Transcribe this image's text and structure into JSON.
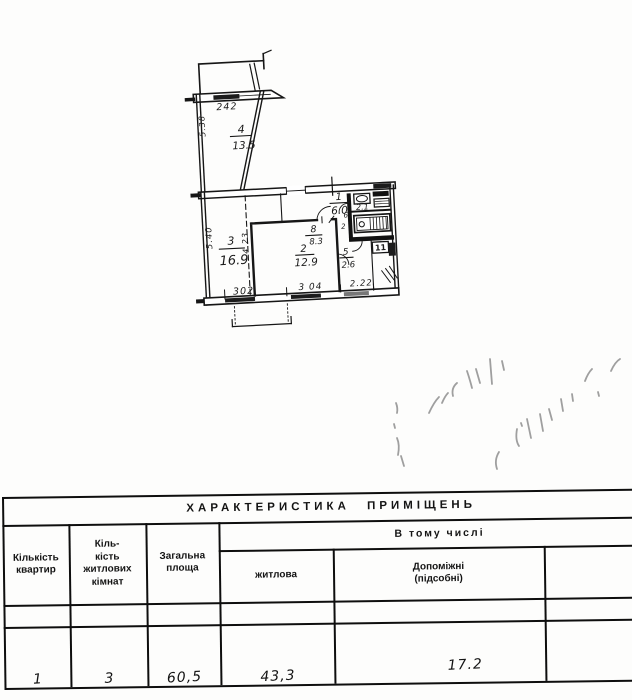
{
  "plan": {
    "labels": {
      "balcony_width": "242",
      "room4_depth": "5.38",
      "room4_number": "4",
      "room4_area": "13.5",
      "room3_depth": "5.40",
      "room3_number": "3",
      "room3_area": "16.9",
      "hall_number": "1",
      "hall_area": "6.0",
      "kitchen_number": "8",
      "kitchen_area": "8.3",
      "room2_number": "2",
      "room2_area": "12.9",
      "room2_depth": "4.23",
      "bath_area": "2.1",
      "wc_number": "5",
      "wc_area": "2.6",
      "box_label": "11",
      "door_mark_a": "6",
      "door_mark_b": "2",
      "dim_302": "302",
      "dim_304": "3 04",
      "dim_222": "2.22"
    }
  },
  "table": {
    "title": "ХАРАКТЕРИСТИКА ПРИМІЩЕНЬ",
    "group_header": "В тому числі",
    "columns": {
      "apartments": "Кількість\nквартир",
      "rooms": "Кіль-\nкість\nжитлових\nкімнат",
      "total_area": "Загальна\nплоща",
      "living": "житлова",
      "auxiliary": "Допоміжні\n(підсобні)"
    },
    "row": {
      "apartments": "1",
      "rooms": "3",
      "total_area": "60,5",
      "living": "43,3",
      "auxiliary": "17.2"
    }
  }
}
